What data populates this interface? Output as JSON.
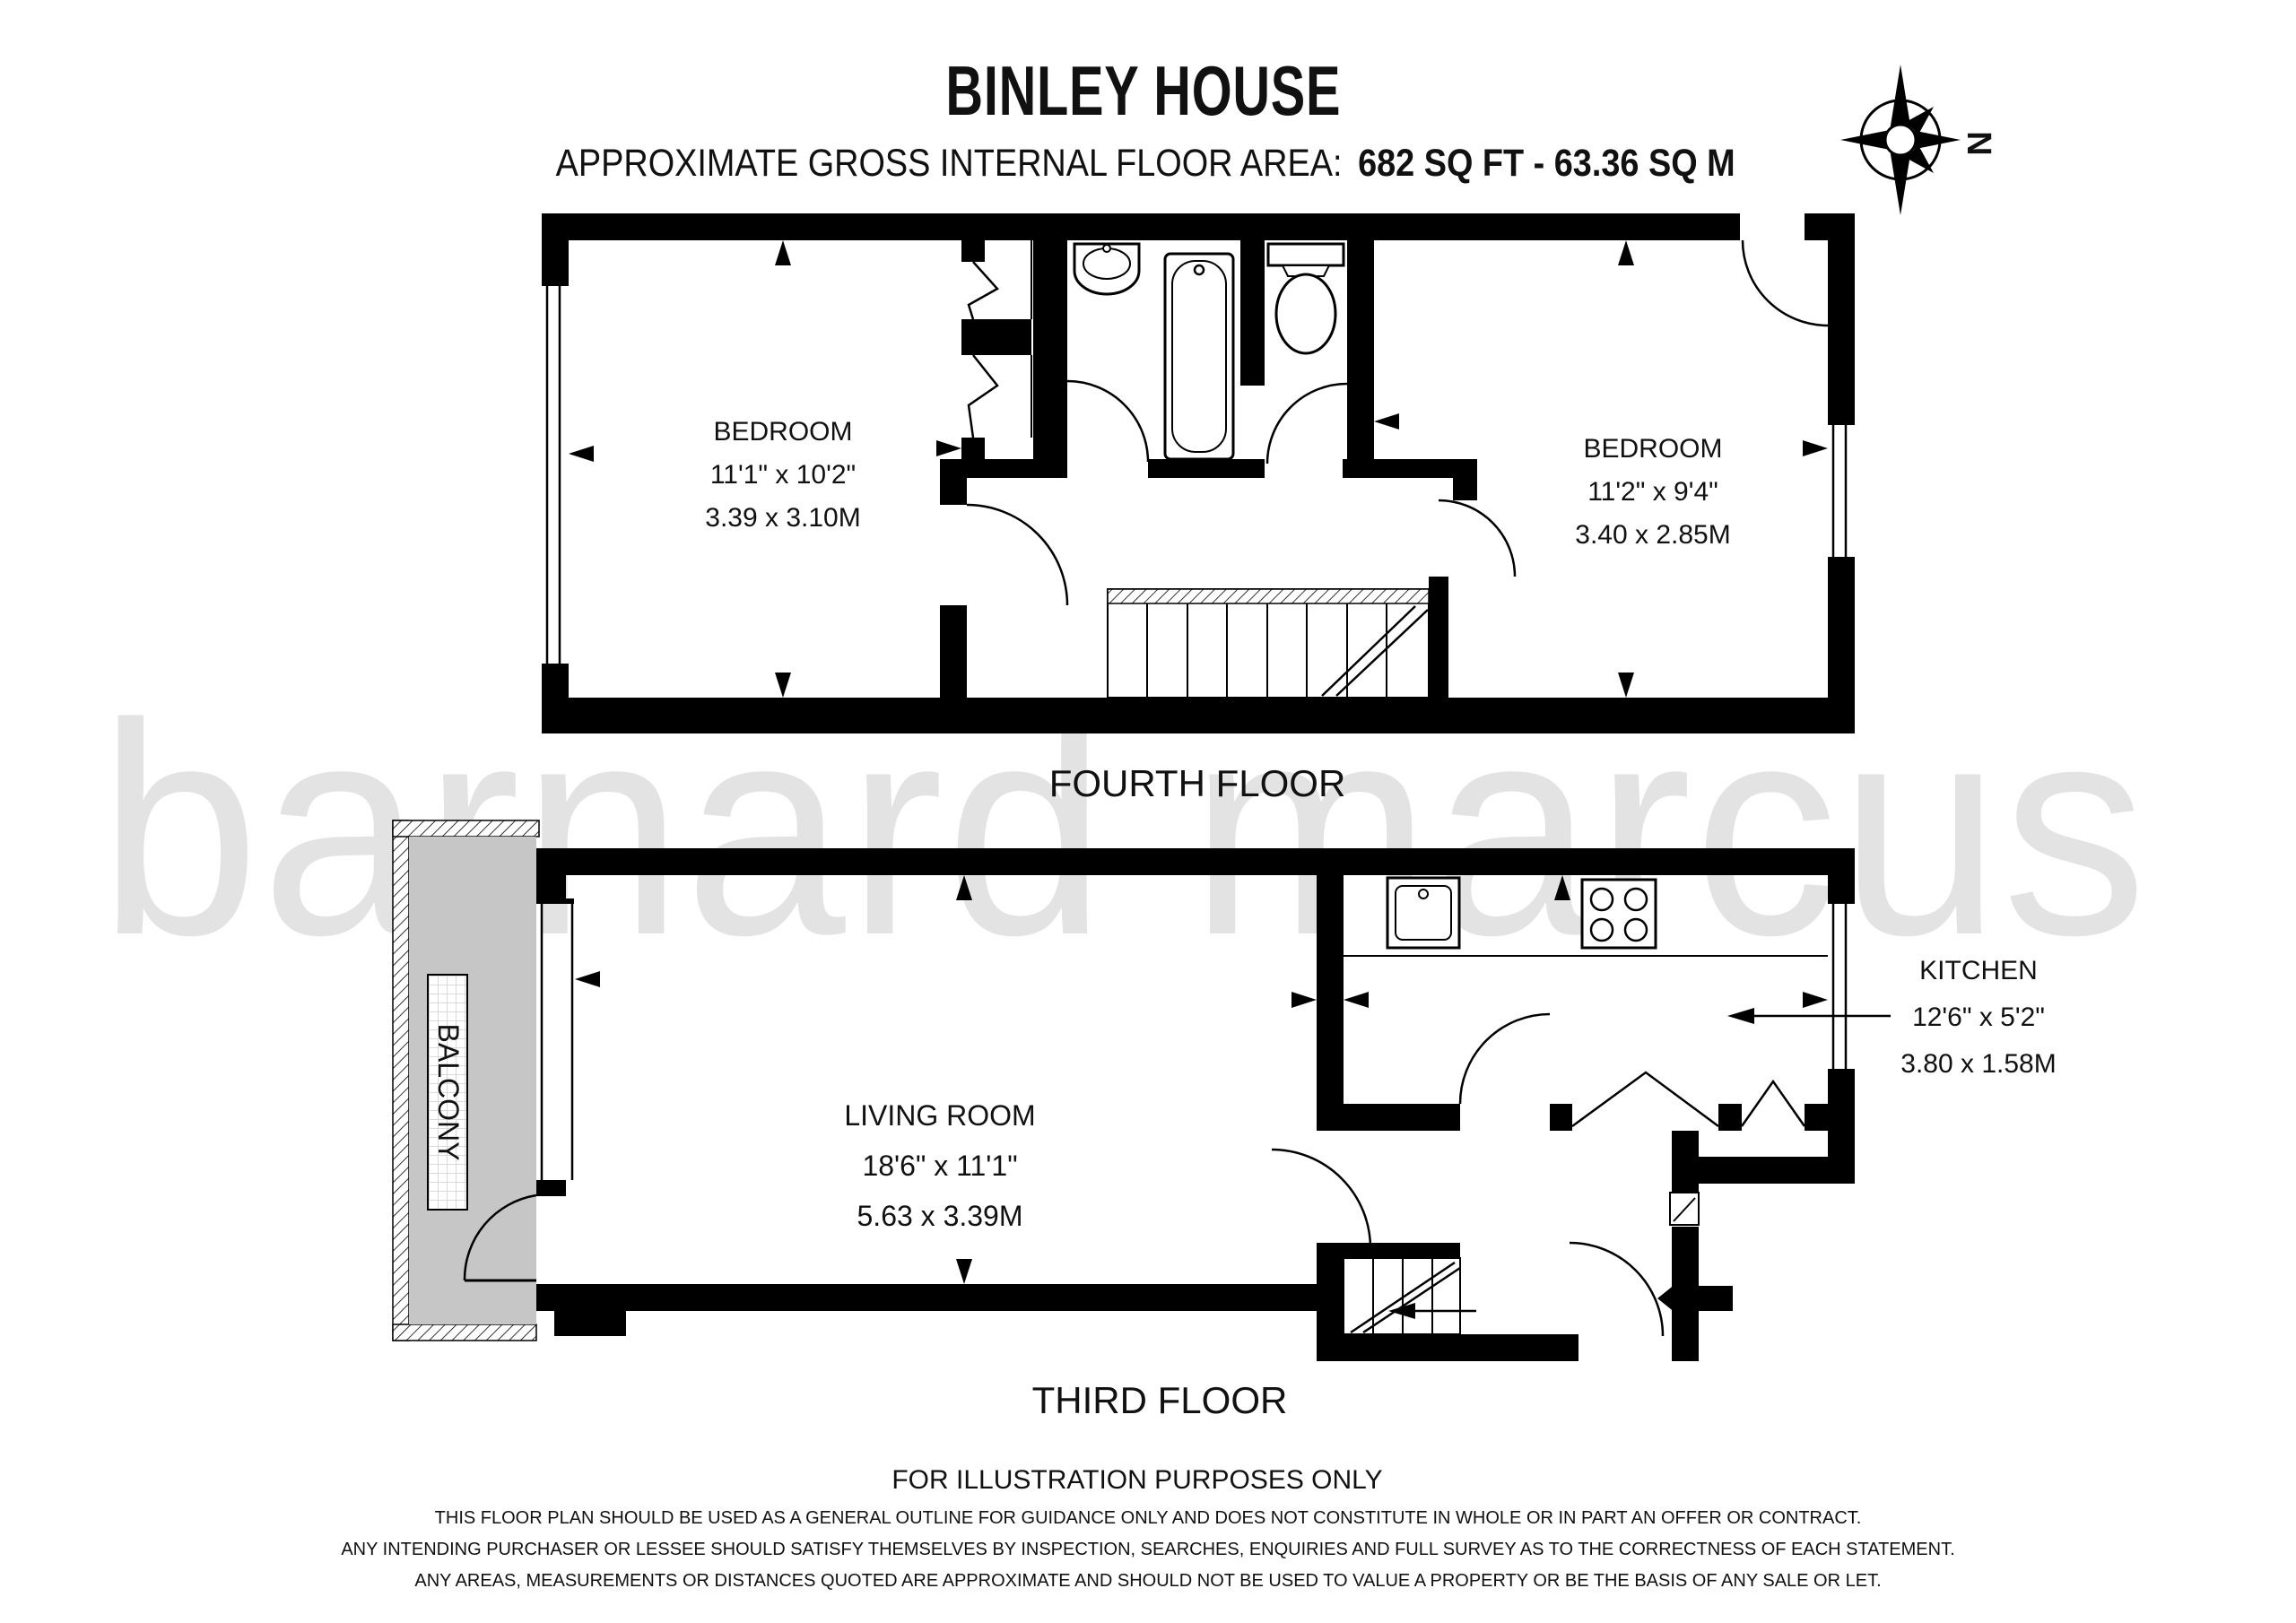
{
  "header": {
    "title": "BINLEY HOUSE",
    "area_label": "APPROXIMATE GROSS INTERNAL FLOOR AREA:",
    "area_value": "682 SQ FT - 63.36 SQ M"
  },
  "compass": {
    "north_label": "N"
  },
  "watermark": {
    "text": "barnard marcus"
  },
  "floors": {
    "fourth": {
      "label": "FOURTH FLOOR",
      "bedroom1": {
        "name": "BEDROOM",
        "imperial": "11'1\" x 10'2\"",
        "metric": "3.39 x 3.10M"
      },
      "bedroom2": {
        "name": "BEDROOM",
        "imperial": "11'2\" x 9'4\"",
        "metric": "3.40 x 2.85M"
      }
    },
    "third": {
      "label": "THIRD FLOOR",
      "living_room": {
        "name": "LIVING ROOM",
        "imperial": "18'6\" x 11'1\"",
        "metric": "5.63 x 3.39M"
      },
      "kitchen": {
        "name": "KITCHEN",
        "imperial": "12'6\" x 5'2\"",
        "metric": "3.80 x 1.58M"
      },
      "balcony": {
        "name": "BALCONY"
      }
    }
  },
  "footer": {
    "illustration_note": "FOR ILLUSTRATION PURPOSES ONLY",
    "disclaimer": [
      "THIS FLOOR PLAN SHOULD BE USED AS A GENERAL OUTLINE FOR GUIDANCE ONLY AND DOES NOT CONSTITUTE IN WHOLE OR IN PART AN OFFER OR CONTRACT.",
      "ANY INTENDING PURCHASER OR LESSEE SHOULD SATISFY THEMSELVES BY INSPECTION, SEARCHES, ENQUIRIES AND FULL SURVEY AS TO THE CORRECTNESS OF EACH STATEMENT.",
      "ANY AREAS, MEASUREMENTS OR DISTANCES QUOTED ARE APPROXIMATE AND SHOULD NOT BE USED TO VALUE A PROPERTY OR BE THE BASIS OF ANY SALE OR LET."
    ]
  },
  "colors": {
    "wall": "#000000",
    "balcony_fill": "#c6c6c6",
    "watermark": "#e3e3e3",
    "text": "#111111"
  }
}
